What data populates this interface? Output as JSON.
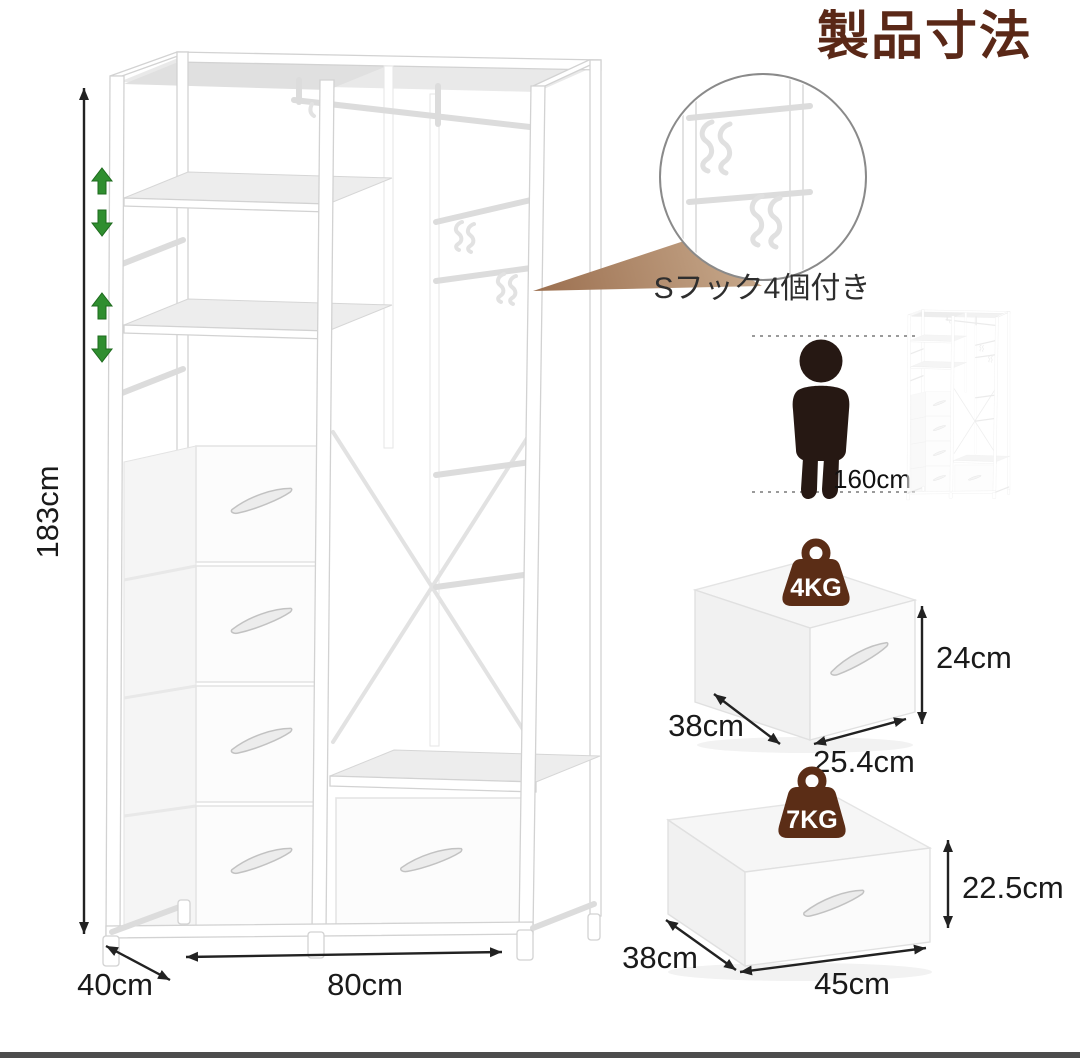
{
  "page": {
    "title": "製品寸法"
  },
  "wardrobe": {
    "height": "183cm",
    "width": "80cm",
    "depth": "40cm"
  },
  "hook_callout": {
    "label": "Sフック4個付き"
  },
  "height_comparison": {
    "person_height": "160cm"
  },
  "drawers": {
    "small": {
      "max_load": "4KG",
      "height": "24cm",
      "width": "25.4cm",
      "depth": "38cm"
    },
    "large": {
      "max_load": "7KG",
      "height": "22.5cm",
      "width": "45cm",
      "depth": "38cm"
    }
  },
  "colors": {
    "title_brown": "#5a2817",
    "badge_brown": "#5b2d16",
    "adjust_arrow_green": "#2f8e2f",
    "callout_triangle_tan": "#b5916f",
    "silhouette_dark": "#261813",
    "dimension_black": "#222222",
    "frame_gray": "#d6d6d6",
    "footer_gray": "#4d4d4d"
  }
}
